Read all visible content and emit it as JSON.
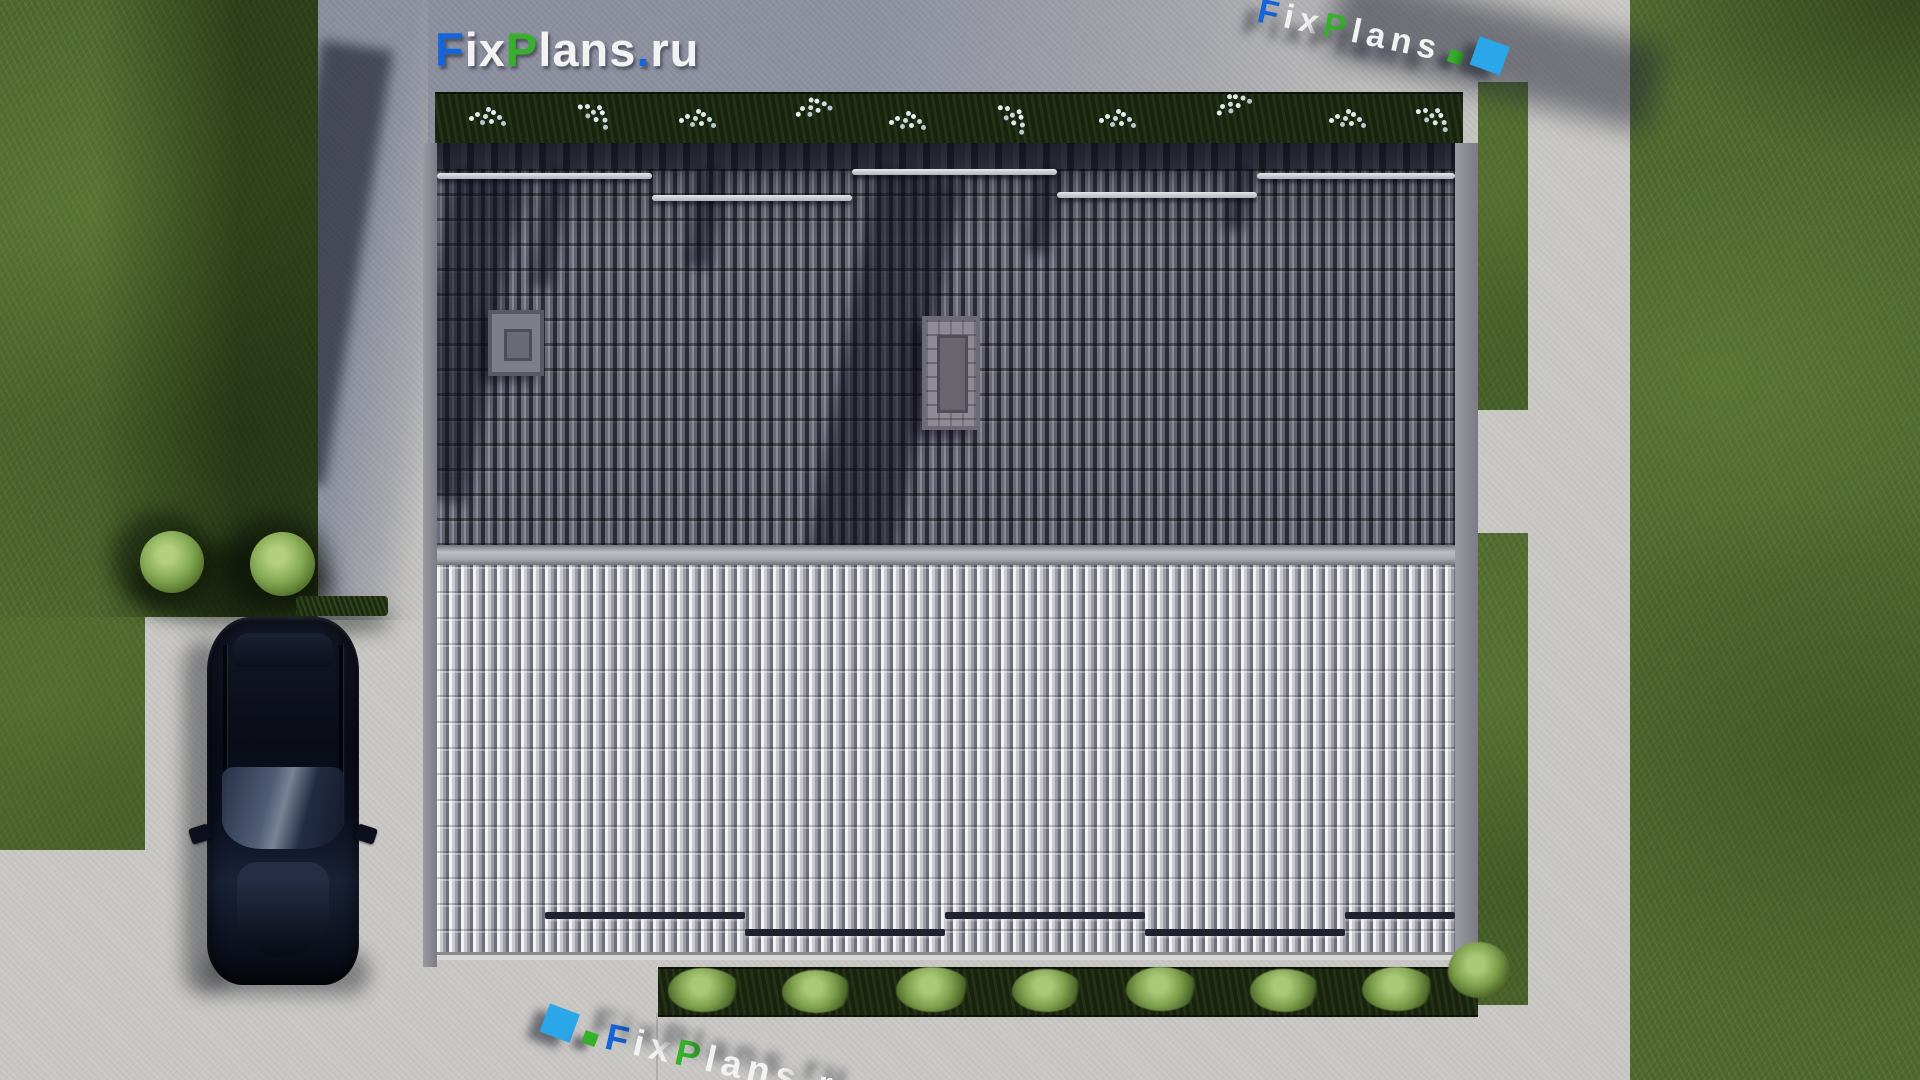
{
  "brand": {
    "full_text": "FixPlans.ru",
    "segments": [
      {
        "text": "F",
        "color": "#1565d8"
      },
      {
        "text": "ix",
        "color": "#f2f2f2"
      },
      {
        "text": "P",
        "color": "#36b02a"
      },
      {
        "text": "lans",
        "color": "#f2f2f2"
      },
      {
        "text": ".",
        "color": "#1565d8"
      },
      {
        "text": "ru",
        "color": "#f2f2f2"
      }
    ]
  },
  "watermarks": {
    "top_right": {
      "text": "FixPlans.ru"
    },
    "bottom": {
      "text": "FixPlans.ru"
    }
  },
  "colors": {
    "logo_blue": "#1565d8",
    "logo_green": "#36b02a",
    "logo_white": "#f2f2f2",
    "cursor_block_azure": "#2ba6e8",
    "grass": "#4f6a2e",
    "concrete_walkway": "#c9c8c5",
    "concrete_yard_shaded": "#8e92a1",
    "roof_tiles_dark": "#565664",
    "roof_tiles_light": "#c6c6ca",
    "garden_bed": "#18220f",
    "bush_green": "#82a751",
    "car_body": "#0a0d18"
  }
}
